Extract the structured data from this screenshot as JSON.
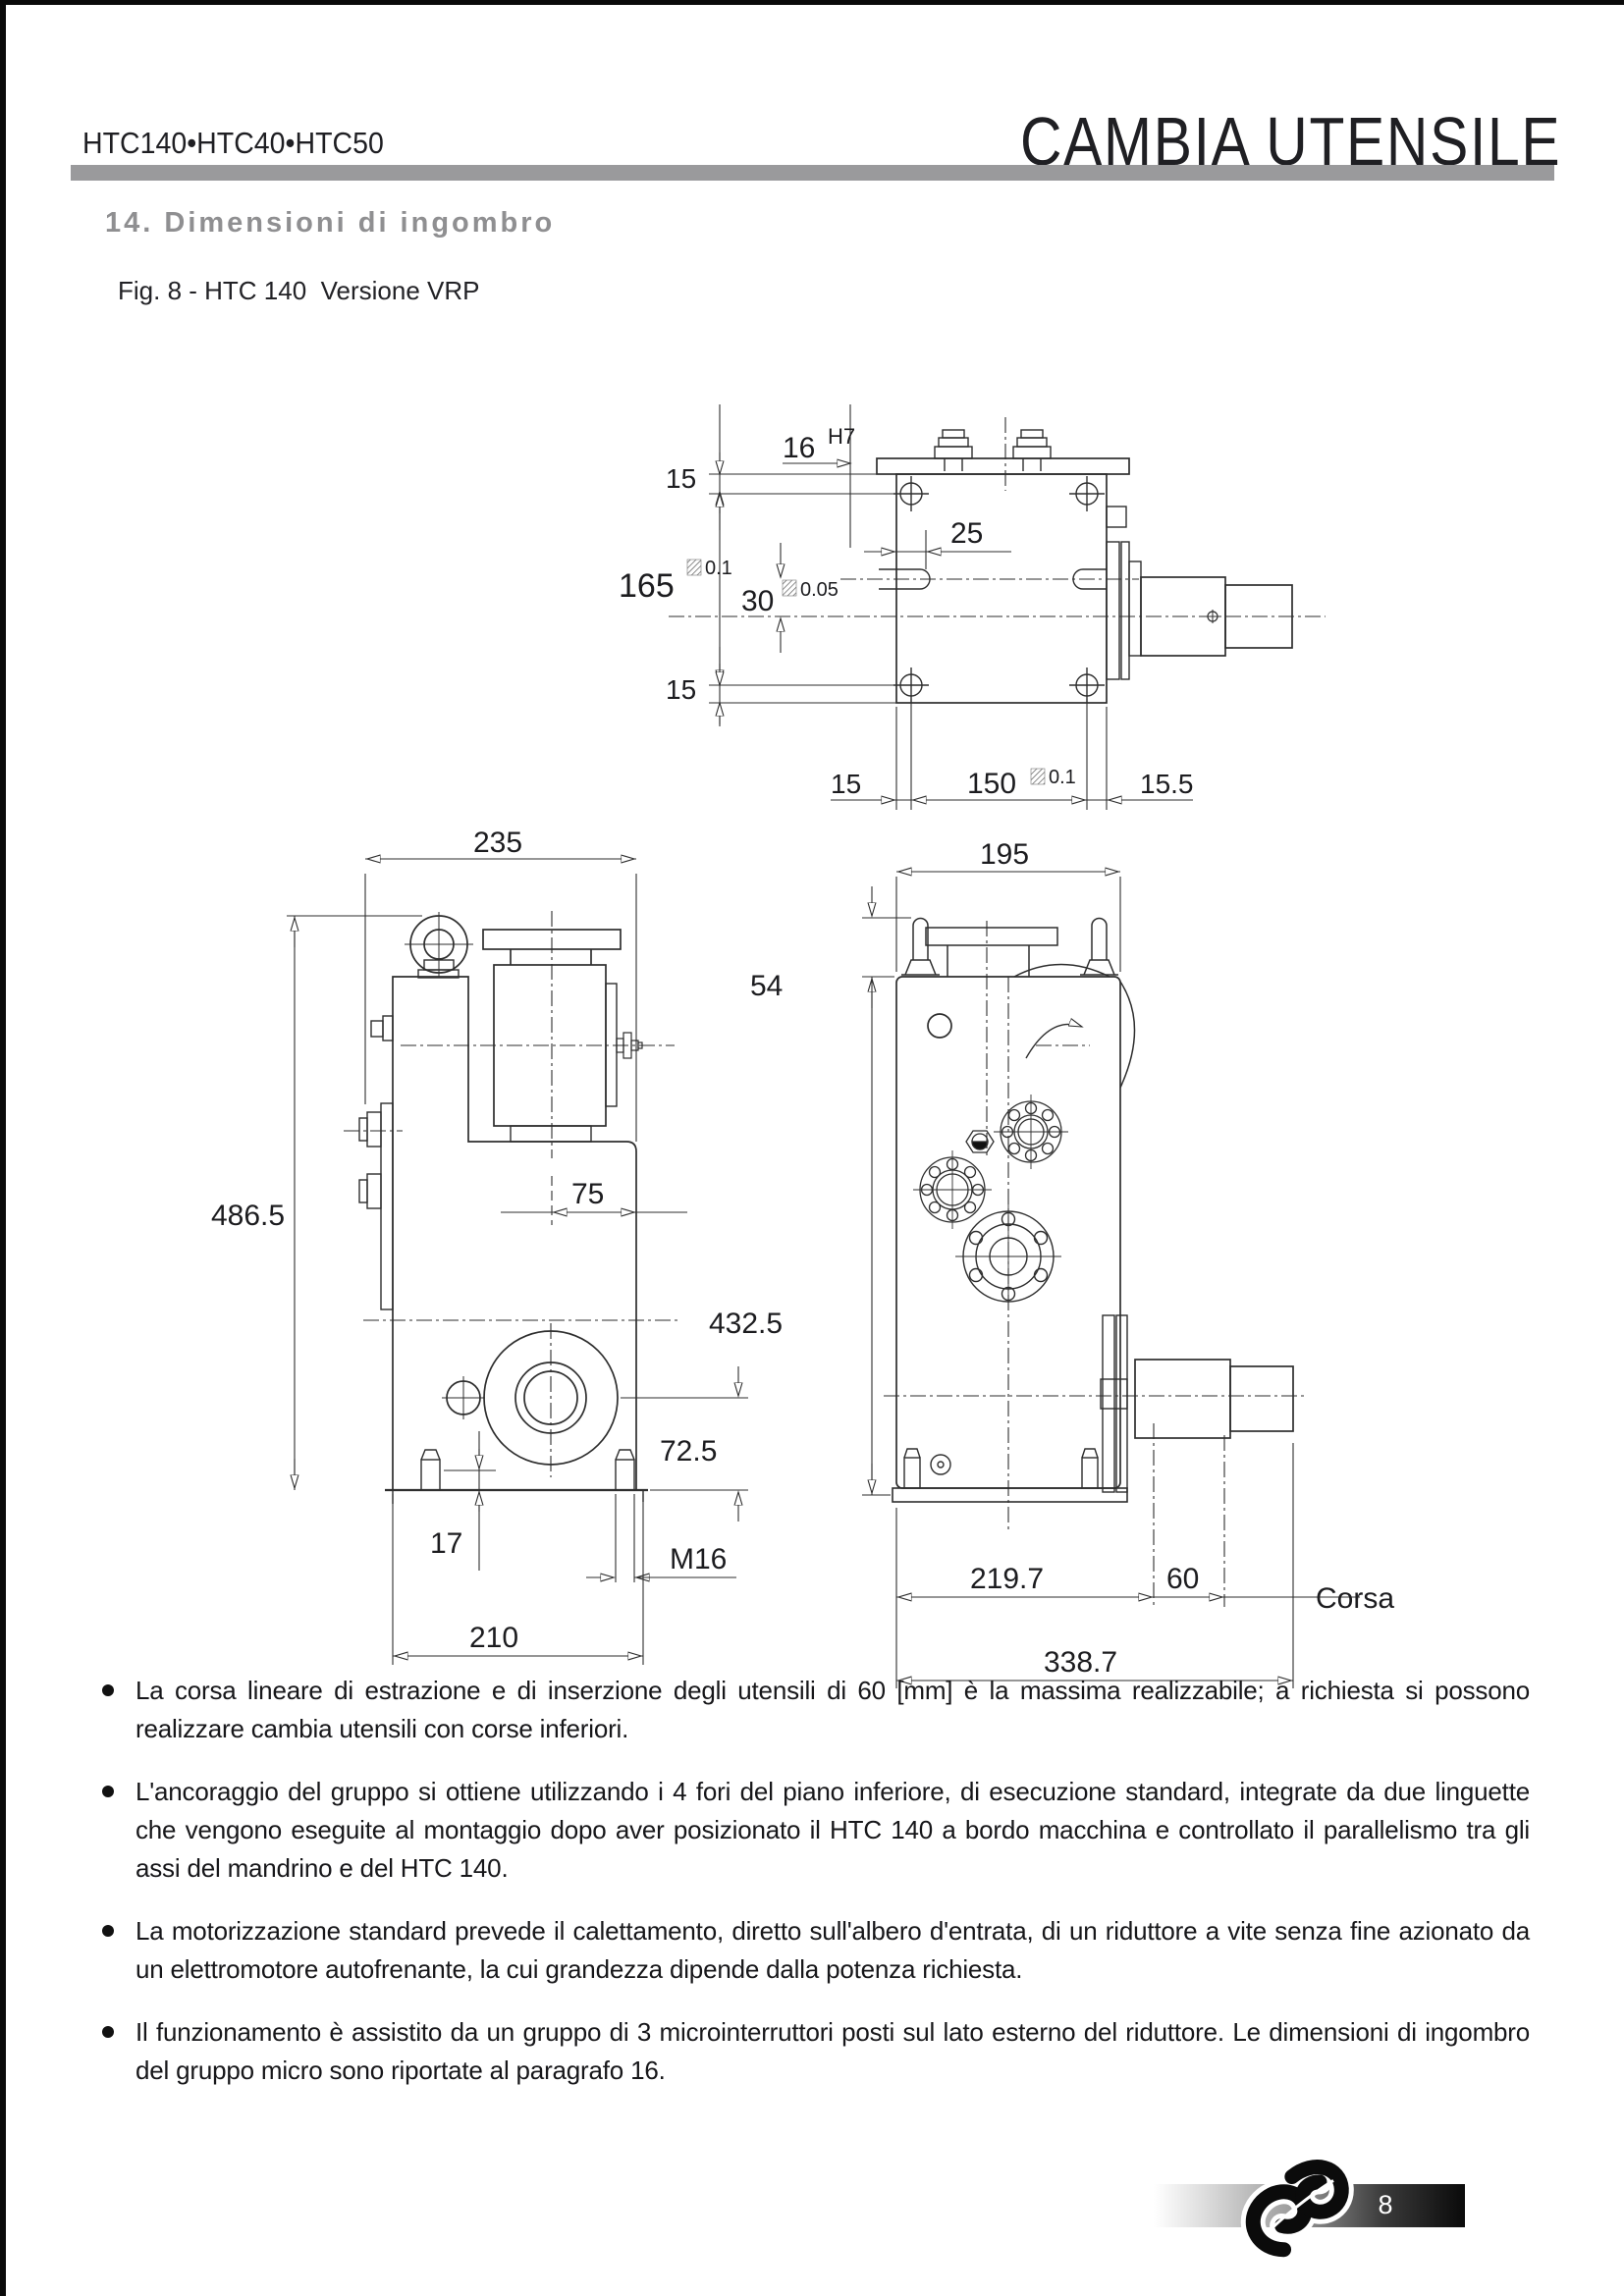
{
  "header": {
    "models": "HTC140•HTC40•HTC50",
    "doc_title": "CAMBIA UTENSILE"
  },
  "section": {
    "title": "14. Dimensioni di ingombro"
  },
  "figure": {
    "caption": "Fig. 8 - HTC 140  Versione VRP"
  },
  "dims": {
    "top": {
      "w16": "16",
      "fit16": "H7",
      "m15a": "15",
      "m165": "165",
      "t165": "0.1",
      "m30": "30",
      "t30": "0.05",
      "m25": "25",
      "m15b": "15",
      "b15": "15",
      "b150": "150",
      "tb150": "0.1",
      "b155": "15.5"
    },
    "front": {
      "w235": "235",
      "h486": "486.5",
      "w75": "75",
      "h72": "72.5",
      "h17": "17",
      "m16": "M16",
      "w210": "210"
    },
    "side": {
      "w195": "195",
      "h54": "54",
      "h432": "432.5",
      "w219": "219.7",
      "w60": "60",
      "corsa": "Corsa",
      "w338": "338.7"
    }
  },
  "notes": [
    "La corsa lineare di estrazione e di inserzione degli utensili di 60 [mm] è la massima realizzabile; a richiesta si possono realizzare cambia utensili con corse inferiori.",
    "L'ancoraggio del gruppo si ottiene utilizzando i 4 fori del piano inferiore, di esecuzione standard, integrate da due linguette che vengono eseguite al montaggio dopo aver posizionato il HTC 140 a bordo macchina e controllato il parallelismo tra gli assi  del mandrino e del HTC 140.",
    "La motorizzazione standard prevede il calettamento, diretto sull'albero d'entrata, di un riduttore a vite senza fine azionato da un elettromotore autofrenante, la cui grandezza dipende dalla potenza richiesta.",
    "Il funzionamento è assistito da un gruppo di 3 microinterruttori posti sul lato esterno del riduttore. Le dimensioni di ingombro del gruppo micro sono riportate al paragrafo  16."
  ],
  "footer": {
    "page_number": "8"
  },
  "colors": {
    "accent_gray": "#9a9a9c",
    "title_gray": "#8f8f91",
    "ink": "#1c1c1f"
  }
}
